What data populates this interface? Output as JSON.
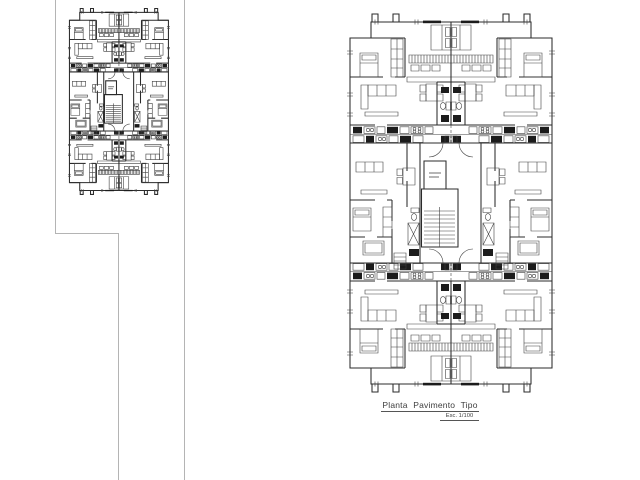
{
  "drawing": {
    "title": "Planta Pavimento Tipo",
    "scale_label": "Esc. 1/100"
  },
  "colors": {
    "ink": "#2b2b2b",
    "dark_fill": "#1c1c1c",
    "boundary_line": "#b4b4b4",
    "background": "#ffffff"
  }
}
